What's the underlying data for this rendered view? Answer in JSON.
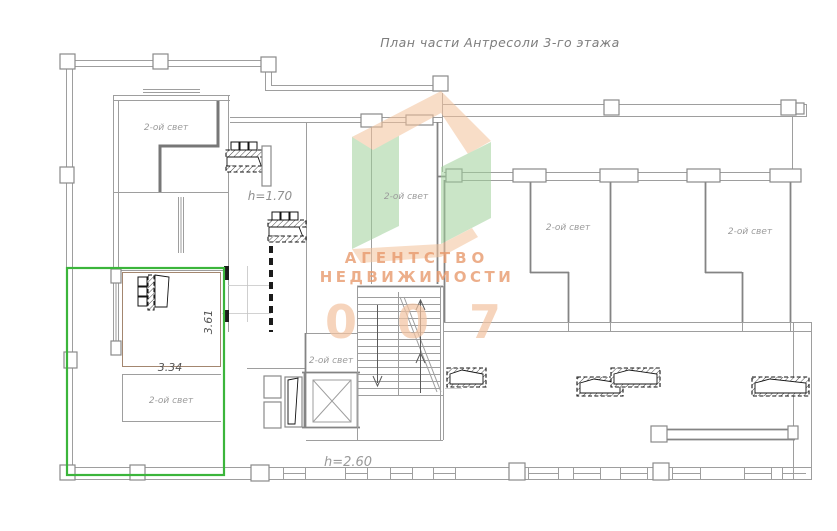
{
  "title": "План части Антресоли 3-го этажа",
  "plan": {
    "room_label": "2-ой свет",
    "heights": {
      "mezzanine": "h=1.70",
      "lower": "h=2.60"
    },
    "dimensions": {
      "width": "3.34",
      "depth": "3.61"
    }
  },
  "watermark": {
    "line1": "АГЕНТСТВО",
    "line2": "НЕДВИЖИМОСТИ",
    "number": "0 0 7"
  },
  "colors": {
    "highlight_green": "#3bb53b",
    "watermark_orange": "#f4c29b",
    "watermark_green": "#9fd09a",
    "watermark_text": "#e89a6e",
    "watermark_number": "#f3c3a1"
  }
}
